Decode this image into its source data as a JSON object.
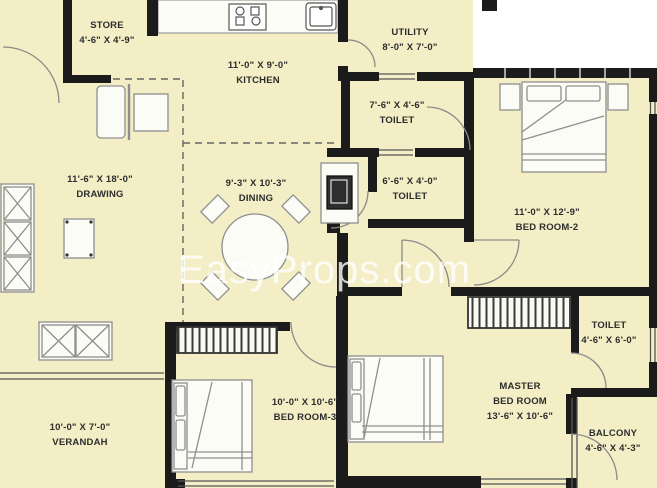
{
  "watermark": "EasyProps.com",
  "colors": {
    "room_fill": "#F3EEC5",
    "wall": "#1B1B1B",
    "furniture_line": "#8E8E8E",
    "label_text": "#2D2D2D",
    "watermark_color": "rgba(255,255,255,0.8)"
  },
  "fixtures": [
    "stove-icon",
    "sink-icon",
    "refrigerator-icon",
    "dining-table-icon",
    "sofa-icon",
    "coffee-table-icon",
    "window-seat-icon",
    "bed-icon",
    "nightstand-icon",
    "wardrobe-icon",
    "door-arc",
    "window"
  ],
  "rooms": {
    "store": {
      "line1": "STORE",
      "line2": "4'-6\" X 4'-9\""
    },
    "kitchen": {
      "line1": "11'-0\" X 9'-0\"",
      "line2": "KITCHEN"
    },
    "utility": {
      "line1": "UTILITY",
      "line2": "8'-0\" X 7'-0\""
    },
    "toilet_top": {
      "line1": "7'-6\" X 4'-6\"",
      "line2": "TOILET"
    },
    "drawing": {
      "line1": "11'-6\" X 18'-0\"",
      "line2": "DRAWING"
    },
    "dining": {
      "line1": "9'-3\" X 10'-3\"",
      "line2": "DINING"
    },
    "toilet_mid": {
      "line1": "6'-6\" X 4'-0\"",
      "line2": "TOILET"
    },
    "bedroom2": {
      "line1": "11'-0\" X 12'-9\"",
      "line2": "BED ROOM-2"
    },
    "toilet_right": {
      "line1": "TOILET",
      "line2": "4'-6\" X 6'-0\""
    },
    "master": {
      "line1": "MASTER",
      "line2": "BED ROOM",
      "line3": "13'-6\" X 10'-6\""
    },
    "bedroom3": {
      "line1": "10'-0\" X 10'-6\"",
      "line2": "BED ROOM-3"
    },
    "verandah": {
      "line1": "10'-0\" X 7'-0\"",
      "line2": "VERANDAH"
    },
    "balcony": {
      "line1": "BALCONY",
      "line2": "4'-6\" X 4'-3\""
    }
  }
}
